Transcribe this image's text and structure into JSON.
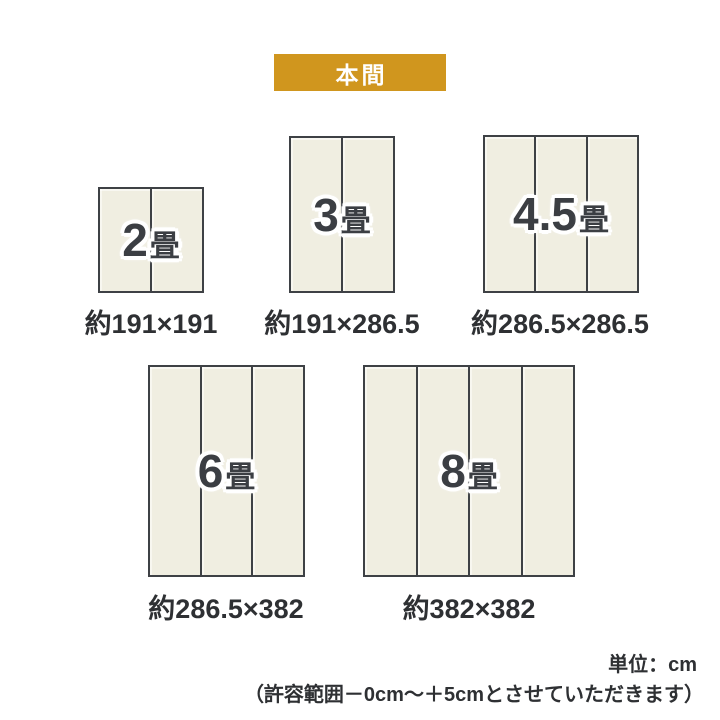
{
  "badge": {
    "label": "本間"
  },
  "panels": [
    {
      "name": "2-tatami",
      "size_value": "2",
      "size_unit": "畳",
      "sections": 2,
      "dimensions": "約191×191"
    },
    {
      "name": "3-tatami",
      "size_value": "3",
      "size_unit": "畳",
      "sections": 2,
      "dimensions": "約191×286.5"
    },
    {
      "name": "4.5-tatami",
      "size_value": "4.5",
      "size_unit": "畳",
      "sections": 3,
      "dimensions": "約286.5×286.5"
    },
    {
      "name": "6-tatami",
      "size_value": "6",
      "size_unit": "畳",
      "sections": 3,
      "dimensions": "約286.5×382"
    },
    {
      "name": "8-tatami",
      "size_value": "8",
      "size_unit": "畳",
      "sections": 4,
      "dimensions": "約382×382"
    }
  ],
  "footer": {
    "unit_label": "単位：cm",
    "tolerance_note": "（許容範囲－0cm～＋5cmとさせていただきます）"
  },
  "colors": {
    "badge_bg": "#D0961E",
    "badge_text": "#FFFFFF",
    "tatami_fill": "#F0EEE1",
    "tatami_border": "#3E4145",
    "label_text": "#3B3E43",
    "caption_text": "#2E3033"
  }
}
